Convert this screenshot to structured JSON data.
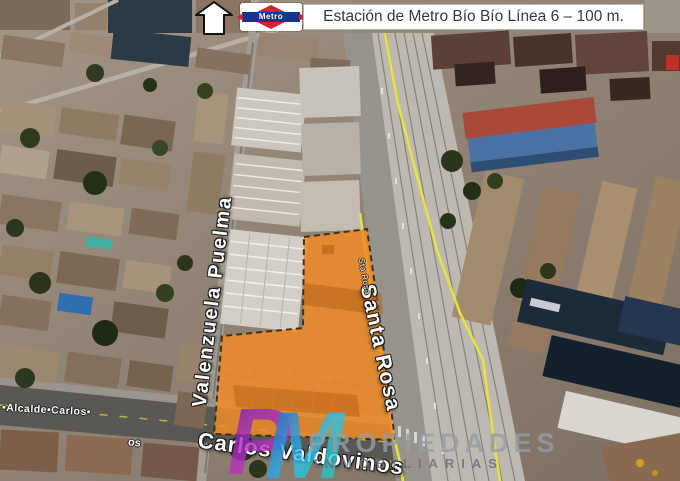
{
  "banner": {
    "metro_logo_text": "Metro",
    "station_text": "Estación de Metro Bío Bío Línea 6 – 100 m."
  },
  "streets": {
    "valenzuela_puelma": "Valenzuela Puelma",
    "santa_rosa": "Santa Rosa",
    "santa_rosa_small": "Sta Rosa",
    "carlos_valdovinos": "Carlos Valdovinos",
    "alcalde_carlos": "•Alcalde•Carlos•",
    "fragment_os": "os"
  },
  "watermark": {
    "letter_p": "P",
    "letter_m": "M",
    "line1": "PROPIEDADES",
    "line2": "INMOBILIARIAS"
  },
  "colors": {
    "lot_highlight": "#f08c28",
    "boundary_yellow": "#e8e240",
    "metro_red": "#d4232a",
    "metro_blue": "#15338f",
    "logo_purple": "#8a2bc8",
    "logo_cyan": "#2bc8e0"
  }
}
